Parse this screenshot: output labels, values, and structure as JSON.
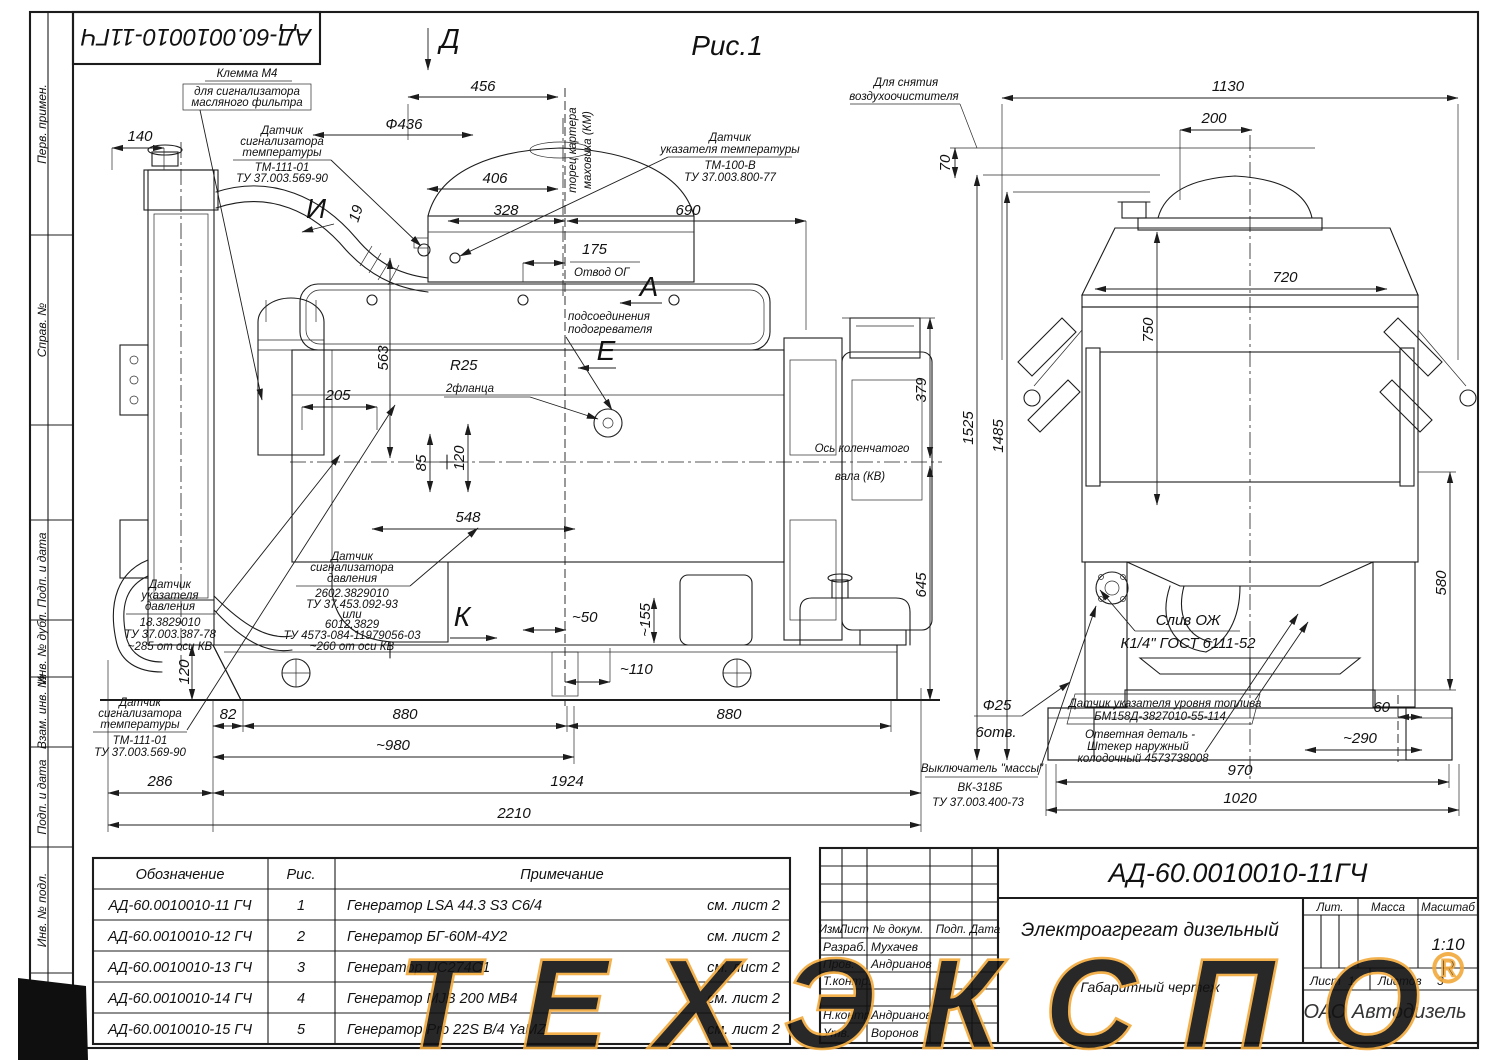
{
  "page": {
    "figure": "Рис.1",
    "stamp": "АД-60.0010010-11ГЧ"
  },
  "sidebar": {
    "labels": [
      "Перв. примен.",
      "Справ. №",
      "Подп. и дата",
      "Инв. № дубл.",
      "Взам. инв. №",
      "Подп. и дата",
      "Инв. № подл."
    ]
  },
  "sv": {
    "va": "А",
    "vd": "Д",
    "ve": "Е",
    "vi": "И",
    "vk": "К",
    "d140": "140",
    "d456": "456",
    "d436": "Ф436",
    "d406": "406",
    "d328": "328",
    "d690": "690",
    "d175": "175",
    "otvod": "Отвод ОГ",
    "d19": "19",
    "fly1": "торец картера",
    "fly2": "маховика (КМ)",
    "d563": "563",
    "r25": "R25",
    "fl": "2фланца",
    "d205": "205",
    "d85": "85",
    "d120": "120",
    "d548": "548",
    "heat1": "подсоединения",
    "heat2": "подогревателя",
    "d50": "~50",
    "d155": "~155",
    "d110": "~110",
    "ax1": "Ось коленчатого",
    "ax2": "вала (КВ)",
    "d379": "379",
    "d645": "645",
    "d1525": "1525",
    "d1485": "1485",
    "dbase": "120",
    "d82": "82",
    "d880a": "880",
    "d880b": "880",
    "d980": "~980",
    "d286": "286",
    "d1924": "1924",
    "d2210": "2210",
    "klemma": [
      "Клемма М4",
      "для сигнализатора",
      "масляного фильтра"
    ],
    "tsT": [
      "Датчик",
      "сигнализатора",
      "температуры",
      "ТМ-111-01",
      "ТУ 37.003.569-90"
    ],
    "tgT": [
      "Датчик",
      "указателя температуры",
      "ТМ-100-В",
      "ТУ 37.003.800-77"
    ],
    "pg": [
      "Датчик",
      "указателя",
      "давления",
      "18.3829010",
      "ТУ 37.003.387-78",
      "~285 от оси КВ"
    ],
    "ps": [
      "Датчик",
      "сигнализатора",
      "давления",
      "2602.3829010",
      "ТУ 37.453.092-93",
      "или",
      "6012.3829",
      "ТУ 4573-084-11979056-03",
      "~260 от оси КВ"
    ],
    "tsB": [
      "Датчик",
      "сигнализатора",
      "температуры",
      "ТМ-111-01",
      "ТУ 37.003.569-90"
    ]
  },
  "fv": {
    "rem1": "Для снятия",
    "rem2": "воздухоочистителя",
    "d1130": "1130",
    "d200": "200",
    "d70": "70",
    "d750": "750",
    "d720": "720",
    "d580": "580",
    "d60": "60",
    "d290": "~290",
    "d970": "970",
    "d1020": "1020",
    "drain1": "Слив ОЖ",
    "drain2": "К1/4\" ГОСТ 6111-52",
    "fuel1": "Датчик указателя уровня топлива",
    "fuel2": "БМ158Д-3827010-55-114",
    "plug1": "Ответная деталь -",
    "plug2": "Штекер наружный",
    "plug3": "колодочный 4573738008",
    "hole1": "Ф25",
    "hole2": "6отв.",
    "sw1": "Выключатель \"массы\"",
    "sw2": "ВК-318Б",
    "sw3": "ТУ 37.003.400-73"
  },
  "table": {
    "h": [
      "Обозначение",
      "Рис.",
      "Примечание"
    ],
    "rows": [
      {
        "d": "АД-60.0010010-11 ГЧ",
        "f": "1",
        "n": "Генератор LSA 44.3 S3 C6/4",
        "s": "см. лист 2"
      },
      {
        "d": "АД-60.0010010-12 ГЧ",
        "f": "2",
        "n": "Генератор БГ-60М-4У2",
        "s": "см. лист 2"
      },
      {
        "d": "АД-60.0010010-13 ГЧ",
        "f": "3",
        "n": "Генератор UC274C1",
        "s": "см. лист 2"
      },
      {
        "d": "АД-60.0010010-14 ГЧ",
        "f": "4",
        "n": "Генератор MJB 200 MB4",
        "s": "см. лист 2"
      },
      {
        "d": "АД-60.0010010-15 ГЧ",
        "f": "5",
        "n": "Генератор Pro 22S B/4 YaMZ",
        "s": "см. лист 2"
      }
    ]
  },
  "tb": {
    "doc": "АД-60.0010010-11ГЧ",
    "name": "Электроагрегат дизельный",
    "type": "Габаритный чертеж",
    "izm": "Изм.",
    "list": "Лист",
    "ndoc": "№ докум.",
    "podp": "Подп.",
    "date": "Дата",
    "lit": "Лит.",
    "mass": "Масса",
    "scalelbl": "Масштаб",
    "scale": "1:10",
    "sheetlbl": "Лист",
    "sheetno": "1",
    "sheetslbl": "Листов",
    "sheetsno": "3",
    "r1": "Разраб.",
    "n1": "Мухачев",
    "r2": "Пров.",
    "n2": "Андрианов",
    "r3": "Т.контр.",
    "r5": "Н.контр.",
    "n5": "Андрианов",
    "r6": "Утв.",
    "n6": "Воронов"
  },
  "wm": {
    "text": "ТЕХЭКСПО",
    "reg": "®",
    "ghost": "ОАО Автодизель",
    "color": "#F2A93B",
    "ghost_color": "#F6D7A4"
  }
}
